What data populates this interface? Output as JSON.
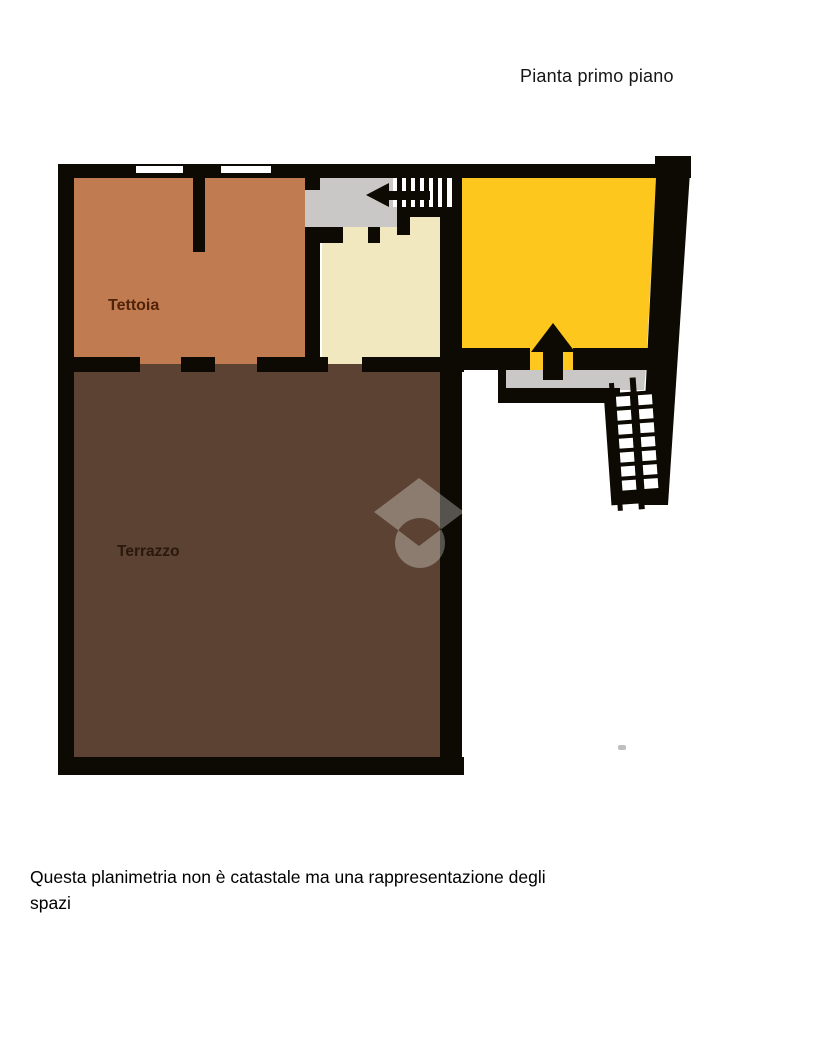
{
  "page": {
    "title": "Pianta primo piano",
    "disclaimer_line1": "Questa planimetria non è catastale ma una rappresentazione degli",
    "disclaimer_line2": "spazi"
  },
  "floorplan": {
    "room_labels": {
      "tettoia": "Tettoia",
      "terrazzo": "Terrazzo"
    },
    "colors": {
      "wall": "#0d0903",
      "tettoia_fill": "#c17b50",
      "terrazzo_fill": "#5b4232",
      "yellow_room_fill": "#fdc71d",
      "cream_room_fill": "#f2e8c0",
      "landing_fill": "#c9c8c6",
      "window_fill": "#ffffff",
      "tettoia_label_color": "#4f2309",
      "terrazzo_label_color": "#2a180d",
      "watermark_overlay": "rgba(255,255,255,0.30)"
    }
  }
}
